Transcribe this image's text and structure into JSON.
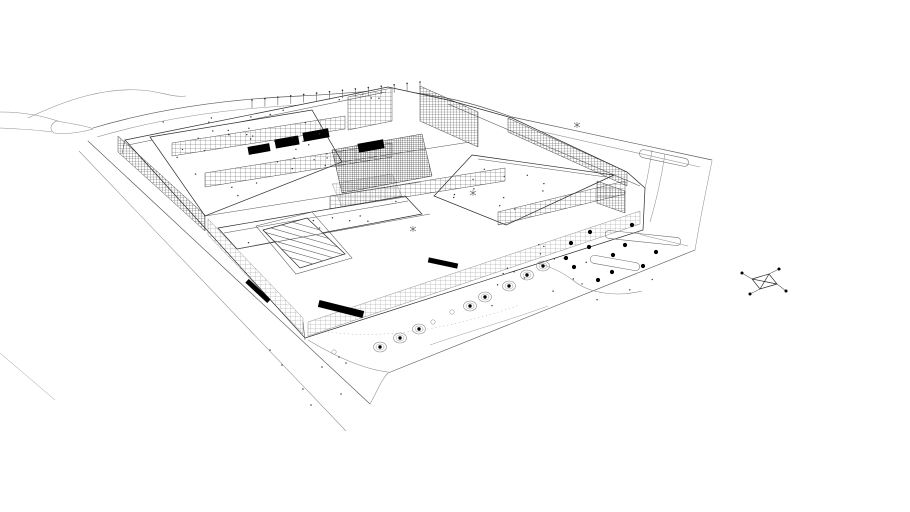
{
  "app": {
    "name": "architectural-wireframe-view",
    "description": "Monochrome hidden-line wireframe perspective of a large rectangular campus building with inner courtyards, a striped pool court, gridded curtain-wall facades, perimeter roads, parking islands and trees",
    "view": "aerial three-quarter perspective",
    "visible_text": []
  },
  "palette": {
    "background": "#ffffff",
    "ink": "#2a2a2a",
    "ink_mid": "#555555",
    "ink_faint": "#9a9a9a",
    "solid_black": "#000000"
  },
  "entities": {
    "circle_trees": [
      [
        380,
        347
      ],
      [
        400,
        338
      ],
      [
        419,
        329
      ],
      [
        470,
        306
      ],
      [
        485,
        297
      ],
      [
        509,
        286
      ],
      [
        527,
        275
      ],
      [
        543,
        266
      ]
    ],
    "open_circles": [
      [
        452,
        312
      ],
      [
        433,
        322
      ],
      [
        334,
        352
      ]
    ],
    "dot_trees": [
      [
        625,
        245
      ],
      [
        656,
        252
      ],
      [
        613,
        255
      ],
      [
        643,
        266
      ],
      [
        612,
        272
      ],
      [
        598,
        280
      ],
      [
        574,
        267
      ],
      [
        589,
        247
      ],
      [
        571,
        243
      ],
      [
        632,
        225
      ],
      [
        590,
        232
      ],
      [
        566,
        258
      ]
    ],
    "misc_dots": [
      [
        339,
        357
      ],
      [
        346,
        363
      ],
      [
        322,
        367
      ],
      [
        303,
        389
      ],
      [
        341,
        394
      ],
      [
        311,
        405
      ],
      [
        282,
        365
      ],
      [
        270,
        350
      ]
    ],
    "parking_islands": [
      {
        "cx": 664,
        "cy": 158,
        "len": 50,
        "h": 8,
        "angle": 12
      },
      {
        "cx": 643,
        "cy": 238,
        "len": 76,
        "h": 8,
        "angle": 6
      },
      {
        "cx": 615,
        "cy": 263,
        "len": 50,
        "h": 8,
        "angle": 10
      }
    ],
    "roof_poles": {
      "count": 14,
      "x0": 252,
      "y0": 108,
      "x1": 420,
      "y1": 90,
      "h": 8
    },
    "sparkle_marks": [
      [
        577,
        125
      ],
      [
        473,
        193
      ],
      [
        413,
        229
      ]
    ],
    "black_blocks": [
      [
        259,
        149,
        22,
        8,
        -10
      ],
      [
        287,
        142,
        24,
        9,
        -10
      ],
      [
        316,
        135,
        26,
        9,
        -10
      ],
      [
        371,
        146,
        26,
        9,
        -10
      ],
      [
        443,
        263,
        30,
        5,
        12
      ],
      [
        341,
        309,
        46,
        7,
        14
      ],
      [
        258,
        291,
        30,
        5,
        43
      ]
    ],
    "facade_bands": [
      {
        "points": "118,136 205,215 205,231 118,152",
        "tone": "dark"
      },
      {
        "points": "208,219 303,318 303,334 208,235",
        "tone": "light"
      },
      {
        "points": "172,143 345,116 345,129 172,156",
        "tone": "mid"
      },
      {
        "points": "205,173 392,143 392,157 205,187",
        "tone": "mid"
      },
      {
        "points": "330,196 505,168 505,181 330,209",
        "tone": "mid"
      },
      {
        "points": "508,118 627,172 627,186 508,132",
        "tone": "dark"
      },
      {
        "points": "498,212 625,181 625,194 498,225",
        "tone": "mid"
      },
      {
        "points": "597,181 625,191 625,213 597,203",
        "tone": "dark"
      },
      {
        "points": "308,322 640,211 640,224 308,336",
        "tone": "light"
      },
      {
        "points": "420,86 478,112 478,147 420,121",
        "tone": "dark"
      },
      {
        "points": "348,97 392,88 392,121 348,130",
        "tone": "mid"
      },
      {
        "points": "332,150 422,134 432,176 342,193",
        "tone": "darkest"
      },
      {
        "points": "332,184 392,174 402,196 342,207",
        "tone": "plaza"
      }
    ],
    "dot_regions": [
      {
        "quad": [
          [
            155,
            140
          ],
          [
            305,
            112
          ],
          [
            340,
            160
          ],
          [
            225,
            205
          ]
        ],
        "n": 30
      },
      {
        "quad": [
          [
            480,
            158
          ],
          [
            605,
            176
          ],
          [
            505,
            220
          ],
          [
            445,
            195
          ]
        ],
        "n": 12
      },
      {
        "quad": [
          [
            470,
            250
          ],
          [
            640,
            235
          ],
          [
            660,
            290
          ],
          [
            480,
            320
          ]
        ],
        "n": 18
      },
      {
        "quad": [
          [
            150,
            120
          ],
          [
            380,
            92
          ],
          [
            385,
            100
          ],
          [
            155,
            130
          ]
        ],
        "n": 10
      },
      {
        "quad": [
          [
            230,
            232
          ],
          [
            400,
            200
          ],
          [
            415,
            214
          ],
          [
            245,
            246
          ]
        ],
        "n": 8
      }
    ],
    "axis_glyph": {
      "cx": 764,
      "cy": 282
    }
  }
}
